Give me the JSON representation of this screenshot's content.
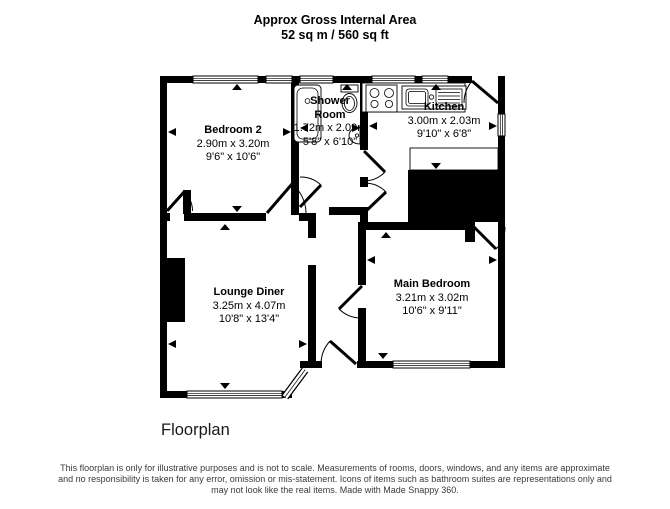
{
  "header": {
    "line1": "Approx Gross Internal Area",
    "line2": "52 sq m / 560 sq ft"
  },
  "rooms": {
    "bedroom2": {
      "name": "Bedroom 2",
      "metric": "2.90m x 3.20m",
      "imperial": "9'6\" x 10'6\""
    },
    "shower_room": {
      "name_line1": "Shower",
      "name_line2": "Room",
      "metric": "1.72m x 2.09m",
      "imperial": "5'8\" x 6'10\""
    },
    "kitchen": {
      "name": "Kitchen",
      "metric": "3.00m x 2.03m",
      "imperial": "9'10\" x 6'8\""
    },
    "lounge_diner": {
      "name": "Lounge Diner",
      "metric": "3.25m x 4.07m",
      "imperial": "10'8\" x 13'4\""
    },
    "main_bedroom": {
      "name": "Main Bedroom",
      "metric": "3.21m x 3.02m",
      "imperial": "10'6\" x 9'11\""
    }
  },
  "plan_label": "Floorplan",
  "footer": {
    "line1": "This floorplan is only for illustrative purposes and is not to scale. Measurements of rooms, doors, windows, and any items are approximate",
    "line2": "and no responsibility is taken for any error, omission or mis-statement. Icons of items such as bathroom suites are representations only and",
    "line3": "may not look like the real items. Made with Made Snappy 360."
  },
  "colors": {
    "wall": "#000000",
    "background": "#ffffff"
  }
}
